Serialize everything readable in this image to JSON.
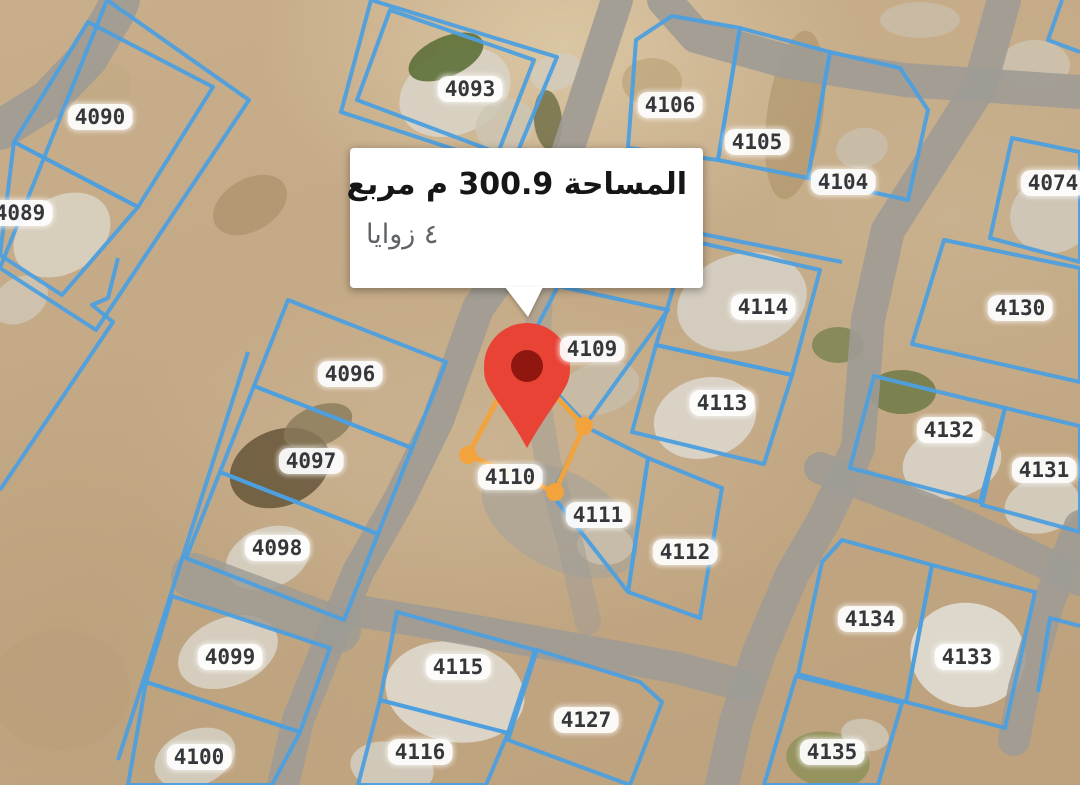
{
  "popup": {
    "area_line": "المساحة 300.9 م مربع",
    "corners_line": "٤ زوايا"
  },
  "marker": {
    "x": 527,
    "y": 448
  },
  "selection": {
    "parcel_id": "4110",
    "points": [
      [
        468,
        455
      ],
      [
        520,
        358
      ],
      [
        584,
        426
      ],
      [
        555,
        492
      ]
    ]
  },
  "colors": {
    "parcel_line": "#4d9fde",
    "selection_line": "#f2a33c",
    "road": "#9e9b95",
    "label_text": "#35373a",
    "label_bg": "#ffffff",
    "marker_body": "#e84335",
    "marker_core": "#8f1710",
    "popup_bg": "#ffffff",
    "popup_text_primary": "#161616",
    "popup_text_secondary": "#5f6368"
  },
  "parcels": [
    {
      "id": "4090",
      "label": {
        "x": 100,
        "y": 117
      },
      "points": [
        [
          14,
          142
        ],
        [
          88,
          22
        ],
        [
          213,
          87
        ],
        [
          138,
          207
        ]
      ]
    },
    {
      "id": "4089",
      "label": {
        "x": 20,
        "y": 213
      },
      "points": [
        [
          0,
          255
        ],
        [
          14,
          142
        ],
        [
          138,
          207
        ],
        [
          62,
          295
        ]
      ]
    },
    {
      "id": "4093",
      "label": {
        "x": 470,
        "y": 89
      },
      "points": [
        [
          390,
          10
        ],
        [
          534,
          60
        ],
        [
          498,
          153
        ],
        [
          357,
          100
        ]
      ]
    },
    {
      "id": "4106",
      "label": {
        "x": 670,
        "y": 105
      },
      "points": [
        [
          628,
          148
        ],
        [
          636,
          40
        ],
        [
          672,
          16
        ],
        [
          740,
          28
        ],
        [
          718,
          160
        ]
      ]
    },
    {
      "id": "4105",
      "label": {
        "x": 757,
        "y": 142
      },
      "points": [
        [
          740,
          28
        ],
        [
          830,
          52
        ],
        [
          808,
          178
        ],
        [
          718,
          160
        ]
      ]
    },
    {
      "id": "4104",
      "label": {
        "x": 843,
        "y": 182
      },
      "points": [
        [
          830,
          52
        ],
        [
          900,
          68
        ],
        [
          928,
          110
        ],
        [
          908,
          200
        ],
        [
          808,
          178
        ]
      ]
    },
    {
      "id": "4074",
      "label": {
        "x": 1053,
        "y": 183
      },
      "points": [
        [
          1012,
          138
        ],
        [
          1080,
          152
        ],
        [
          1080,
          262
        ],
        [
          990,
          238
        ]
      ]
    },
    {
      "id": "4114",
      "label": {
        "x": 763,
        "y": 307
      },
      "points": [
        [
          688,
          240
        ],
        [
          820,
          270
        ],
        [
          792,
          375
        ],
        [
          656,
          345
        ]
      ]
    },
    {
      "id": "4113",
      "label": {
        "x": 722,
        "y": 403
      },
      "points": [
        [
          656,
          345
        ],
        [
          792,
          375
        ],
        [
          764,
          464
        ],
        [
          632,
          432
        ]
      ]
    },
    {
      "id": "4109",
      "label": {
        "x": 592,
        "y": 349
      },
      "points": [
        [
          522,
          356
        ],
        [
          558,
          286
        ],
        [
          668,
          310
        ],
        [
          586,
          424
        ]
      ]
    },
    {
      "id": "4110",
      "label": {
        "x": 510,
        "y": 477
      },
      "points": null
    },
    {
      "id": "4111",
      "label": {
        "x": 598,
        "y": 515
      },
      "points": [
        [
          552,
          495
        ],
        [
          584,
          426
        ],
        [
          648,
          458
        ],
        [
          628,
          592
        ]
      ]
    },
    {
      "id": "4112",
      "label": {
        "x": 685,
        "y": 552
      },
      "points": [
        [
          648,
          458
        ],
        [
          722,
          488
        ],
        [
          700,
          618
        ],
        [
          628,
          592
        ]
      ]
    },
    {
      "id": "4130",
      "label": {
        "x": 1020,
        "y": 308
      },
      "points": [
        [
          944,
          240
        ],
        [
          1080,
          268
        ],
        [
          1080,
          382
        ],
        [
          912,
          344
        ]
      ]
    },
    {
      "id": "4132",
      "label": {
        "x": 949,
        "y": 430
      },
      "points": [
        [
          874,
          376
        ],
        [
          1005,
          408
        ],
        [
          980,
          502
        ],
        [
          850,
          468
        ]
      ]
    },
    {
      "id": "4131",
      "label": {
        "x": 1044,
        "y": 470
      },
      "points": [
        [
          1005,
          408
        ],
        [
          1080,
          426
        ],
        [
          1080,
          532
        ],
        [
          982,
          505
        ]
      ]
    },
    {
      "id": "4096",
      "label": {
        "x": 350,
        "y": 374
      },
      "points": [
        [
          288,
          300
        ],
        [
          446,
          362
        ],
        [
          412,
          448
        ],
        [
          254,
          386
        ]
      ]
    },
    {
      "id": "4097",
      "label": {
        "x": 311,
        "y": 461
      },
      "points": [
        [
          254,
          386
        ],
        [
          412,
          448
        ],
        [
          378,
          534
        ],
        [
          220,
          472
        ]
      ]
    },
    {
      "id": "4098",
      "label": {
        "x": 277,
        "y": 548
      },
      "points": [
        [
          220,
          472
        ],
        [
          378,
          534
        ],
        [
          344,
          620
        ],
        [
          186,
          558
        ]
      ]
    },
    {
      "id": "4099",
      "label": {
        "x": 230,
        "y": 657
      },
      "points": [
        [
          172,
          596
        ],
        [
          330,
          648
        ],
        [
          300,
          732
        ],
        [
          146,
          682
        ]
      ]
    },
    {
      "id": "4100",
      "label": {
        "x": 199,
        "y": 757
      },
      "points": [
        [
          146,
          682
        ],
        [
          300,
          732
        ],
        [
          272,
          785
        ],
        [
          128,
          785
        ]
      ]
    },
    {
      "id": "4134",
      "label": {
        "x": 870,
        "y": 619
      },
      "points": [
        [
          822,
          562
        ],
        [
          842,
          540
        ],
        [
          932,
          565
        ],
        [
          906,
          702
        ],
        [
          798,
          674
        ]
      ]
    },
    {
      "id": "4133",
      "label": {
        "x": 967,
        "y": 657
      },
      "points": [
        [
          932,
          565
        ],
        [
          1035,
          592
        ],
        [
          1005,
          728
        ],
        [
          906,
          702
        ]
      ]
    },
    {
      "id": "4135",
      "label": {
        "x": 832,
        "y": 752
      },
      "points": [
        [
          796,
          676
        ],
        [
          902,
          703
        ],
        [
          878,
          785
        ],
        [
          764,
          785
        ]
      ]
    },
    {
      "id": "4115",
      "label": {
        "x": 458,
        "y": 667
      },
      "points": [
        [
          397,
          612
        ],
        [
          535,
          650
        ],
        [
          508,
          733
        ],
        [
          380,
          700
        ]
      ]
    },
    {
      "id": "4116",
      "label": {
        "x": 420,
        "y": 752
      },
      "points": [
        [
          380,
          700
        ],
        [
          508,
          733
        ],
        [
          486,
          785
        ],
        [
          358,
          785
        ]
      ]
    },
    {
      "id": "4127",
      "label": {
        "x": 586,
        "y": 720
      },
      "points": [
        [
          537,
          650
        ],
        [
          640,
          682
        ],
        [
          662,
          702
        ],
        [
          630,
          785
        ],
        [
          508,
          740
        ]
      ]
    }
  ],
  "boundary_lines": [
    {
      "closed": true,
      "points": [
        [
          107,
          0
        ],
        [
          249,
          100
        ],
        [
          96,
          330
        ],
        [
          0,
          268
        ]
      ]
    },
    {
      "closed": true,
      "points": [
        [
          371,
          0
        ],
        [
          557,
          57
        ],
        [
          511,
          168
        ],
        [
          341,
          112
        ]
      ]
    },
    {
      "closed": false,
      "points": [
        [
          248,
          352
        ],
        [
          118,
          760
        ]
      ]
    },
    {
      "closed": false,
      "points": [
        [
          118,
          258
        ],
        [
          108,
          298
        ],
        [
          92,
          305
        ],
        [
          113,
          322
        ],
        [
          0,
          490
        ]
      ]
    },
    {
      "closed": false,
      "points": [
        [
          1062,
          0
        ],
        [
          1048,
          40
        ],
        [
          1080,
          52
        ]
      ]
    },
    {
      "closed": false,
      "points": [
        [
          1080,
          626
        ],
        [
          1050,
          618
        ],
        [
          1038,
          692
        ]
      ]
    },
    {
      "closed": false,
      "points": [
        [
          672,
          228
        ],
        [
          842,
          262
        ]
      ]
    }
  ],
  "roads": [
    {
      "points": [
        [
          0,
          130
        ],
        [
          48,
          100
        ],
        [
          88,
          58
        ],
        [
          114,
          14
        ],
        [
          120,
          0
        ]
      ],
      "width": 40,
      "opacity": 0.9
    },
    {
      "points": [
        [
          617,
          0
        ],
        [
          568,
          150
        ],
        [
          545,
          215
        ],
        [
          478,
          308
        ],
        [
          438,
          420
        ],
        [
          400,
          498
        ],
        [
          358,
          572
        ],
        [
          330,
          640
        ],
        [
          298,
          720
        ],
        [
          283,
          785
        ]
      ],
      "width": 32,
      "opacity": 0.9
    },
    {
      "points": [
        [
          552,
          210
        ],
        [
          540,
          295
        ],
        [
          535,
          385
        ],
        [
          548,
          462
        ],
        [
          570,
          542
        ],
        [
          588,
          622
        ]
      ],
      "width": 26,
      "opacity": 0.5
    },
    {
      "points": [
        [
          664,
          0
        ],
        [
          696,
          36
        ],
        [
          788,
          62
        ],
        [
          905,
          80
        ],
        [
          1080,
          92
        ]
      ],
      "width": 34,
      "opacity": 0.9
    },
    {
      "points": [
        [
          1004,
          0
        ],
        [
          980,
          86
        ],
        [
          934,
          158
        ],
        [
          888,
          230
        ],
        [
          868,
          320
        ],
        [
          858,
          448
        ],
        [
          824,
          520
        ],
        [
          792,
          575
        ],
        [
          760,
          650
        ],
        [
          736,
          722
        ],
        [
          722,
          785
        ]
      ],
      "width": 34,
      "opacity": 0.9
    },
    {
      "points": [
        [
          352,
          610
        ],
        [
          460,
          628
        ],
        [
          570,
          648
        ],
        [
          678,
          668
        ],
        [
          745,
          686
        ]
      ],
      "width": 32,
      "opacity": 0.88
    },
    {
      "points": [
        [
          820,
          468
        ],
        [
          930,
          510
        ],
        [
          1018,
          550
        ],
        [
          1080,
          580
        ]
      ],
      "width": 32,
      "opacity": 0.88
    },
    {
      "points": [
        [
          1080,
          526
        ],
        [
          1048,
          604
        ],
        [
          1024,
          688
        ],
        [
          1014,
          740
        ]
      ],
      "width": 32,
      "opacity": 0.88
    },
    {
      "points": [
        [
          194,
          576
        ],
        [
          338,
          630
        ]
      ],
      "width": 46,
      "opacity": 0.82
    }
  ],
  "terrain_patches": [
    {
      "cx": 62,
      "cy": 235,
      "rx": 52,
      "ry": 38,
      "rot": -32,
      "fill": "#d9d2c2",
      "opacity": 0.9
    },
    {
      "cx": 20,
      "cy": 300,
      "rx": 30,
      "ry": 22,
      "rot": -32,
      "fill": "#cfc8b8",
      "opacity": 0.8
    },
    {
      "cx": 455,
      "cy": 92,
      "rx": 58,
      "ry": 42,
      "rot": -24,
      "fill": "#d8d2c4",
      "opacity": 0.95
    },
    {
      "cx": 446,
      "cy": 57,
      "rx": 40,
      "ry": 20,
      "rot": -24,
      "fill": "#5e7038",
      "opacity": 0.9
    },
    {
      "cx": 505,
      "cy": 125,
      "rx": 30,
      "ry": 26,
      "rot": -24,
      "fill": "#ccc5b4",
      "opacity": 0.8
    },
    {
      "cx": 556,
      "cy": 72,
      "rx": 26,
      "ry": 18,
      "rot": -20,
      "fill": "#d2cbbb",
      "opacity": 0.85
    },
    {
      "cx": 548,
      "cy": 120,
      "rx": 14,
      "ry": 30,
      "rot": -5,
      "fill": "#6b6c44",
      "opacity": 0.8
    },
    {
      "cx": 652,
      "cy": 82,
      "rx": 30,
      "ry": 24,
      "rot": 0,
      "fill": "#b89e74",
      "opacity": 0.6
    },
    {
      "cx": 862,
      "cy": 148,
      "rx": 26,
      "ry": 20,
      "rot": -12,
      "fill": "#c8bfac",
      "opacity": 0.8
    },
    {
      "cx": 1052,
      "cy": 215,
      "rx": 42,
      "ry": 38,
      "rot": -12,
      "fill": "#d0c9bb",
      "opacity": 0.9
    },
    {
      "cx": 795,
      "cy": 115,
      "rx": 28,
      "ry": 85,
      "rot": 8,
      "fill": "#aa9066",
      "opacity": 0.55
    },
    {
      "cx": 742,
      "cy": 302,
      "rx": 66,
      "ry": 48,
      "rot": -16,
      "fill": "#d5cec1",
      "opacity": 0.95
    },
    {
      "cx": 705,
      "cy": 418,
      "rx": 52,
      "ry": 40,
      "rot": -16,
      "fill": "#dad4c8",
      "opacity": 0.95
    },
    {
      "cx": 600,
      "cy": 388,
      "rx": 40,
      "ry": 26,
      "rot": -16,
      "fill": "#c7beac",
      "opacity": 0.8
    },
    {
      "cx": 838,
      "cy": 345,
      "rx": 26,
      "ry": 18,
      "rot": 0,
      "fill": "#7c8454",
      "opacity": 0.85
    },
    {
      "cx": 902,
      "cy": 392,
      "rx": 34,
      "ry": 22,
      "rot": 0,
      "fill": "#6e7a45",
      "opacity": 0.85
    },
    {
      "cx": 952,
      "cy": 462,
      "rx": 50,
      "ry": 36,
      "rot": -14,
      "fill": "#d8d2c5",
      "opacity": 0.95
    },
    {
      "cx": 1042,
      "cy": 505,
      "rx": 38,
      "ry": 28,
      "rot": -14,
      "fill": "#d4cec1",
      "opacity": 0.9
    },
    {
      "cx": 968,
      "cy": 655,
      "rx": 58,
      "ry": 52,
      "rot": 12,
      "fill": "#dedacd",
      "opacity": 0.97
    },
    {
      "cx": 560,
      "cy": 520,
      "rx": 85,
      "ry": 48,
      "rot": 28,
      "fill": "#a7a399",
      "opacity": 0.65
    },
    {
      "cx": 455,
      "cy": 692,
      "rx": 70,
      "ry": 50,
      "rot": 10,
      "fill": "#dcd6c9",
      "opacity": 0.97
    },
    {
      "cx": 392,
      "cy": 768,
      "rx": 42,
      "ry": 26,
      "rot": 10,
      "fill": "#d2ccbe",
      "opacity": 0.9
    },
    {
      "cx": 828,
      "cy": 760,
      "rx": 42,
      "ry": 28,
      "rot": 10,
      "fill": "#8e9158",
      "opacity": 0.85
    },
    {
      "cx": 865,
      "cy": 735,
      "rx": 24,
      "ry": 16,
      "rot": 10,
      "fill": "#d0caba",
      "opacity": 0.8
    },
    {
      "cx": 280,
      "cy": 468,
      "rx": 52,
      "ry": 38,
      "rot": -22,
      "fill": "#6b5a3e",
      "opacity": 0.9
    },
    {
      "cx": 318,
      "cy": 426,
      "rx": 36,
      "ry": 20,
      "rot": -22,
      "fill": "#8a7a5a",
      "opacity": 0.8
    },
    {
      "cx": 268,
      "cy": 558,
      "rx": 44,
      "ry": 30,
      "rot": -22,
      "fill": "#d6d0c2",
      "opacity": 0.9
    },
    {
      "cx": 228,
      "cy": 652,
      "rx": 52,
      "ry": 34,
      "rot": -22,
      "fill": "#d8d2c4",
      "opacity": 0.9
    },
    {
      "cx": 195,
      "cy": 758,
      "rx": 42,
      "ry": 28,
      "rot": -22,
      "fill": "#d4cec0",
      "opacity": 0.9
    },
    {
      "cx": 250,
      "cy": 205,
      "rx": 40,
      "ry": 26,
      "rot": -30,
      "fill": "#a68e66",
      "opacity": 0.6
    },
    {
      "cx": 95,
      "cy": 95,
      "rx": 40,
      "ry": 28,
      "rot": -35,
      "fill": "#c2aa85",
      "opacity": 0.7
    },
    {
      "cx": 1035,
      "cy": 65,
      "rx": 35,
      "ry": 25,
      "rot": 0,
      "fill": "#cdc5b4",
      "opacity": 0.8
    },
    {
      "cx": 920,
      "cy": 20,
      "rx": 40,
      "ry": 18,
      "rot": 0,
      "fill": "#c9c0ae",
      "opacity": 0.7
    },
    {
      "cx": 60,
      "cy": 690,
      "rx": 70,
      "ry": 60,
      "rot": 0,
      "fill": "#b89e7a",
      "opacity": 0.5
    },
    {
      "cx": 605,
      "cy": 545,
      "rx": 28,
      "ry": 20,
      "rot": 0,
      "fill": "#cfc6b2",
      "opacity": 0.7
    }
  ]
}
